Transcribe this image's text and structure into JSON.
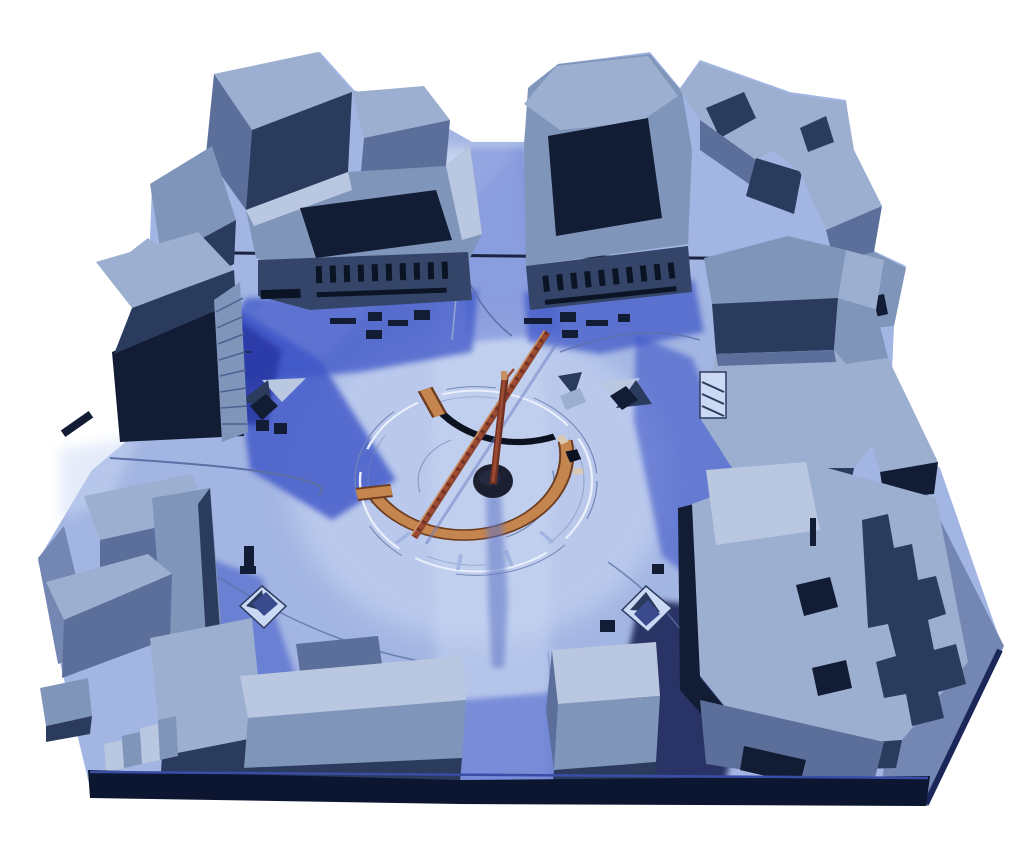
{
  "image": {
    "alt": "Photograph of a blue-tinted architectural scale model of an urban square surrounded by gray block buildings, with a circular monument at the center featuring an orange segmented arc, a black arc, a leaning ladder-like mast and a dark circular pit",
    "subject": "urban square architectural model",
    "visible_text": "none (tiny illegible red marks on one roof)"
  },
  "palette": {
    "background": "#ffffff",
    "plaza_light": "#a3b5e2",
    "plaza_pale": "#ccd9f4",
    "shadow_blue": "#3e55c8",
    "shadow_deep": "#2636a0",
    "shadow_navy": "#1c2758",
    "roof_light": "#9cafd0",
    "roof_lighter": "#bac7e0",
    "roof_mid": "#8095ba",
    "side_mid": "#5b6f9a",
    "side_dark": "#2b3b5e",
    "side_darkest": "#121c34",
    "facade": "#344569",
    "window_dark": "#0b1424",
    "arc_orange": "#c5854f",
    "arc_orange_dark": "#6e3d20",
    "arc_tan": "#d9c9b2",
    "arc_black": "#0d1220",
    "mast_dark": "#713225",
    "mast_main": "#9c4a31",
    "mast_light": "#c98f66",
    "pit": "#1b1f30",
    "base_edge": "#0c1630",
    "base_side": "#7486b2",
    "line_thin": "#5c70a6",
    "curb_light": "#93a6d2",
    "ring_light": "#eaf0fb",
    "red_mark": "#d84a5e"
  }
}
